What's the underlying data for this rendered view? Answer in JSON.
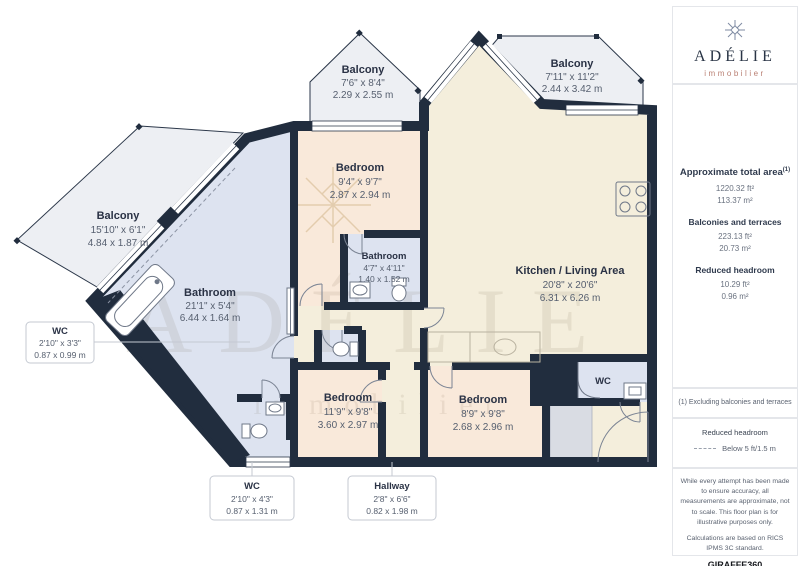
{
  "sidebar": {
    "brand": {
      "name": "ADÉLIE",
      "tagline": "immobilier"
    },
    "total_area": {
      "label": "Approximate total area",
      "sup": "(1)",
      "ft": "1220.32 ft²",
      "m": "113.37 m²"
    },
    "balconies": {
      "label": "Balconies and terraces",
      "ft": "223.13 ft²",
      "m": "20.73 m²"
    },
    "reduced": {
      "label": "Reduced headroom",
      "ft": "10.29 ft²",
      "m": "0.96 m²"
    },
    "note": "(1) Excluding balconies and terraces",
    "legend": {
      "title": "Reduced headroom",
      "item": "Below 5 ft/1.5 m"
    },
    "disclaimer1": "While every attempt has been made to ensure accuracy, all measurements are approximate, not to scale. This floor plan is for illustrative purposes only.",
    "disclaimer2": "Calculations are based on RICS IPMS 3C standard.",
    "credit": {
      "brand": "GIRAFFE",
      "suffix": "360"
    }
  },
  "watermark": {
    "name": "ADÉLIE",
    "tagline": "immobilier"
  },
  "rooms": {
    "balcony_top_left": {
      "name": "Balcony",
      "imperial": "7'6\" x 8'4\"",
      "metric": "2.29 x 2.55 m"
    },
    "balcony_top_right": {
      "name": "Balcony",
      "imperial": "7'11\" x 11'2\"",
      "metric": "2.44 x 3.42 m"
    },
    "balcony_left": {
      "name": "Balcony",
      "imperial": "15'10\" x 6'1\"",
      "metric": "4.84 x 1.87 m"
    },
    "bedroom_top": {
      "name": "Bedroom",
      "imperial": "9'4\" x 9'7\"",
      "metric": "2.87 x 2.94 m"
    },
    "bathroom_small": {
      "name": "Bathroom",
      "imperial": "4'7\" x 4'11\"",
      "metric": "1.40 x 1.52 m"
    },
    "kitchen": {
      "name": "Kitchen / Living Area",
      "imperial": "20'8\" x 20'6\"",
      "metric": "6.31 x 6.26 m"
    },
    "bathroom_large": {
      "name": "Bathroom",
      "imperial": "21'1\" x 5'4\"",
      "metric": "6.44 x 1.64 m"
    },
    "bedroom_bottom_left": {
      "name": "Bedroom",
      "imperial": "11'9\" x 9'8\"",
      "metric": "3.60 x 2.97 m"
    },
    "bedroom_bottom_right": {
      "name": "Bedroom",
      "imperial": "8'9\" x 9'8\"",
      "metric": "2.68 x 2.96 m"
    },
    "wc_right_label": "WC",
    "wc_left": {
      "name": "WC",
      "imperial": "2'10\" x 3'3\"",
      "metric": "0.87 x 0.99 m"
    },
    "wc_bottom": {
      "name": "WC",
      "imperial": "2'10\" x 4'3\"",
      "metric": "0.87 x 1.31 m"
    },
    "hallway": {
      "name": "Hallway",
      "imperial": "2'8\" x 6'6\"",
      "metric": "0.82 x 1.98 m"
    }
  },
  "colors": {
    "wall": "#212d3e",
    "living_floor": "#f4eedc",
    "bedroom_floor": "#f9e9da",
    "bathroom_floor": "#dde3f0",
    "balcony_floor": "#edeff3",
    "storage": "#d9dce3",
    "brand_accent": "#b97f72",
    "label_dark": "#2a3245"
  }
}
